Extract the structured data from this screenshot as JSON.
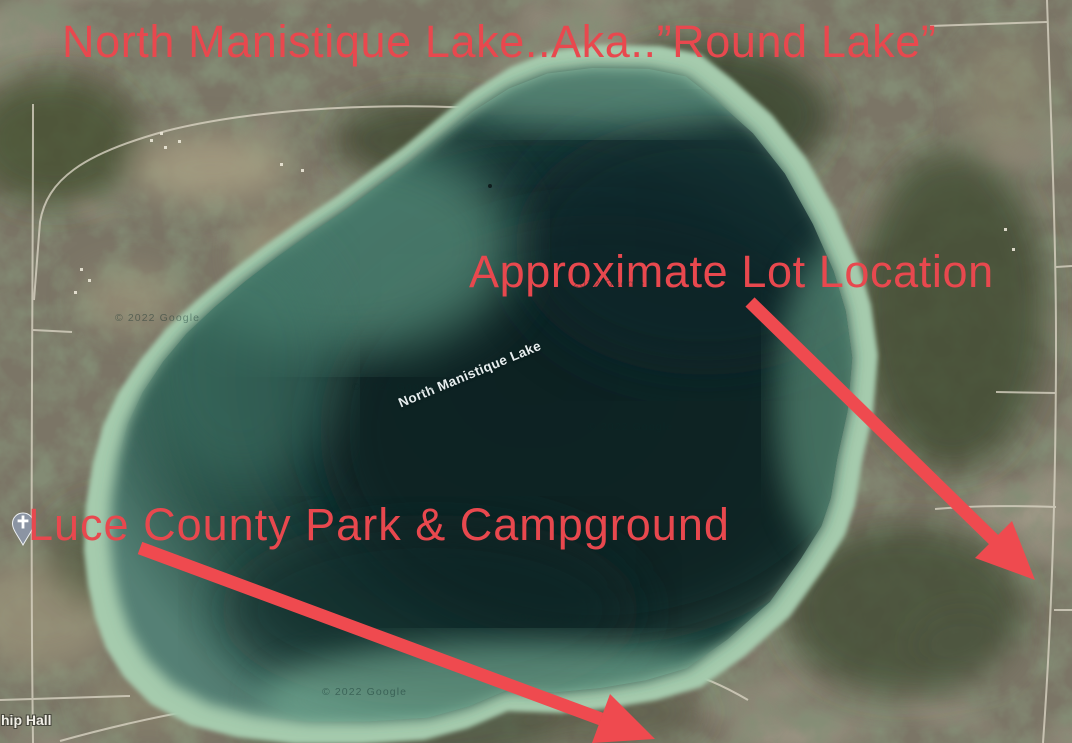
{
  "annotations": {
    "title": "North Manistique Lake..Aka..”Round Lake”",
    "lot_label": "Approximate Lot Location",
    "park_label": "Luce County Park & Campground"
  },
  "map_labels": {
    "lake_name": "North Manistique Lake",
    "township_hall_partial": "hip Hall",
    "copyright": "© 2022 Google"
  },
  "icons": {
    "church_pin": "church-place-marker"
  },
  "colors": {
    "annotation_red": "#e8484e",
    "arrow_red": "#ef4a4f",
    "water_dark": "#0d2326",
    "water_mid": "#2b5349",
    "water_shallow": "#a5cbad",
    "land_base": "#7b7566"
  }
}
